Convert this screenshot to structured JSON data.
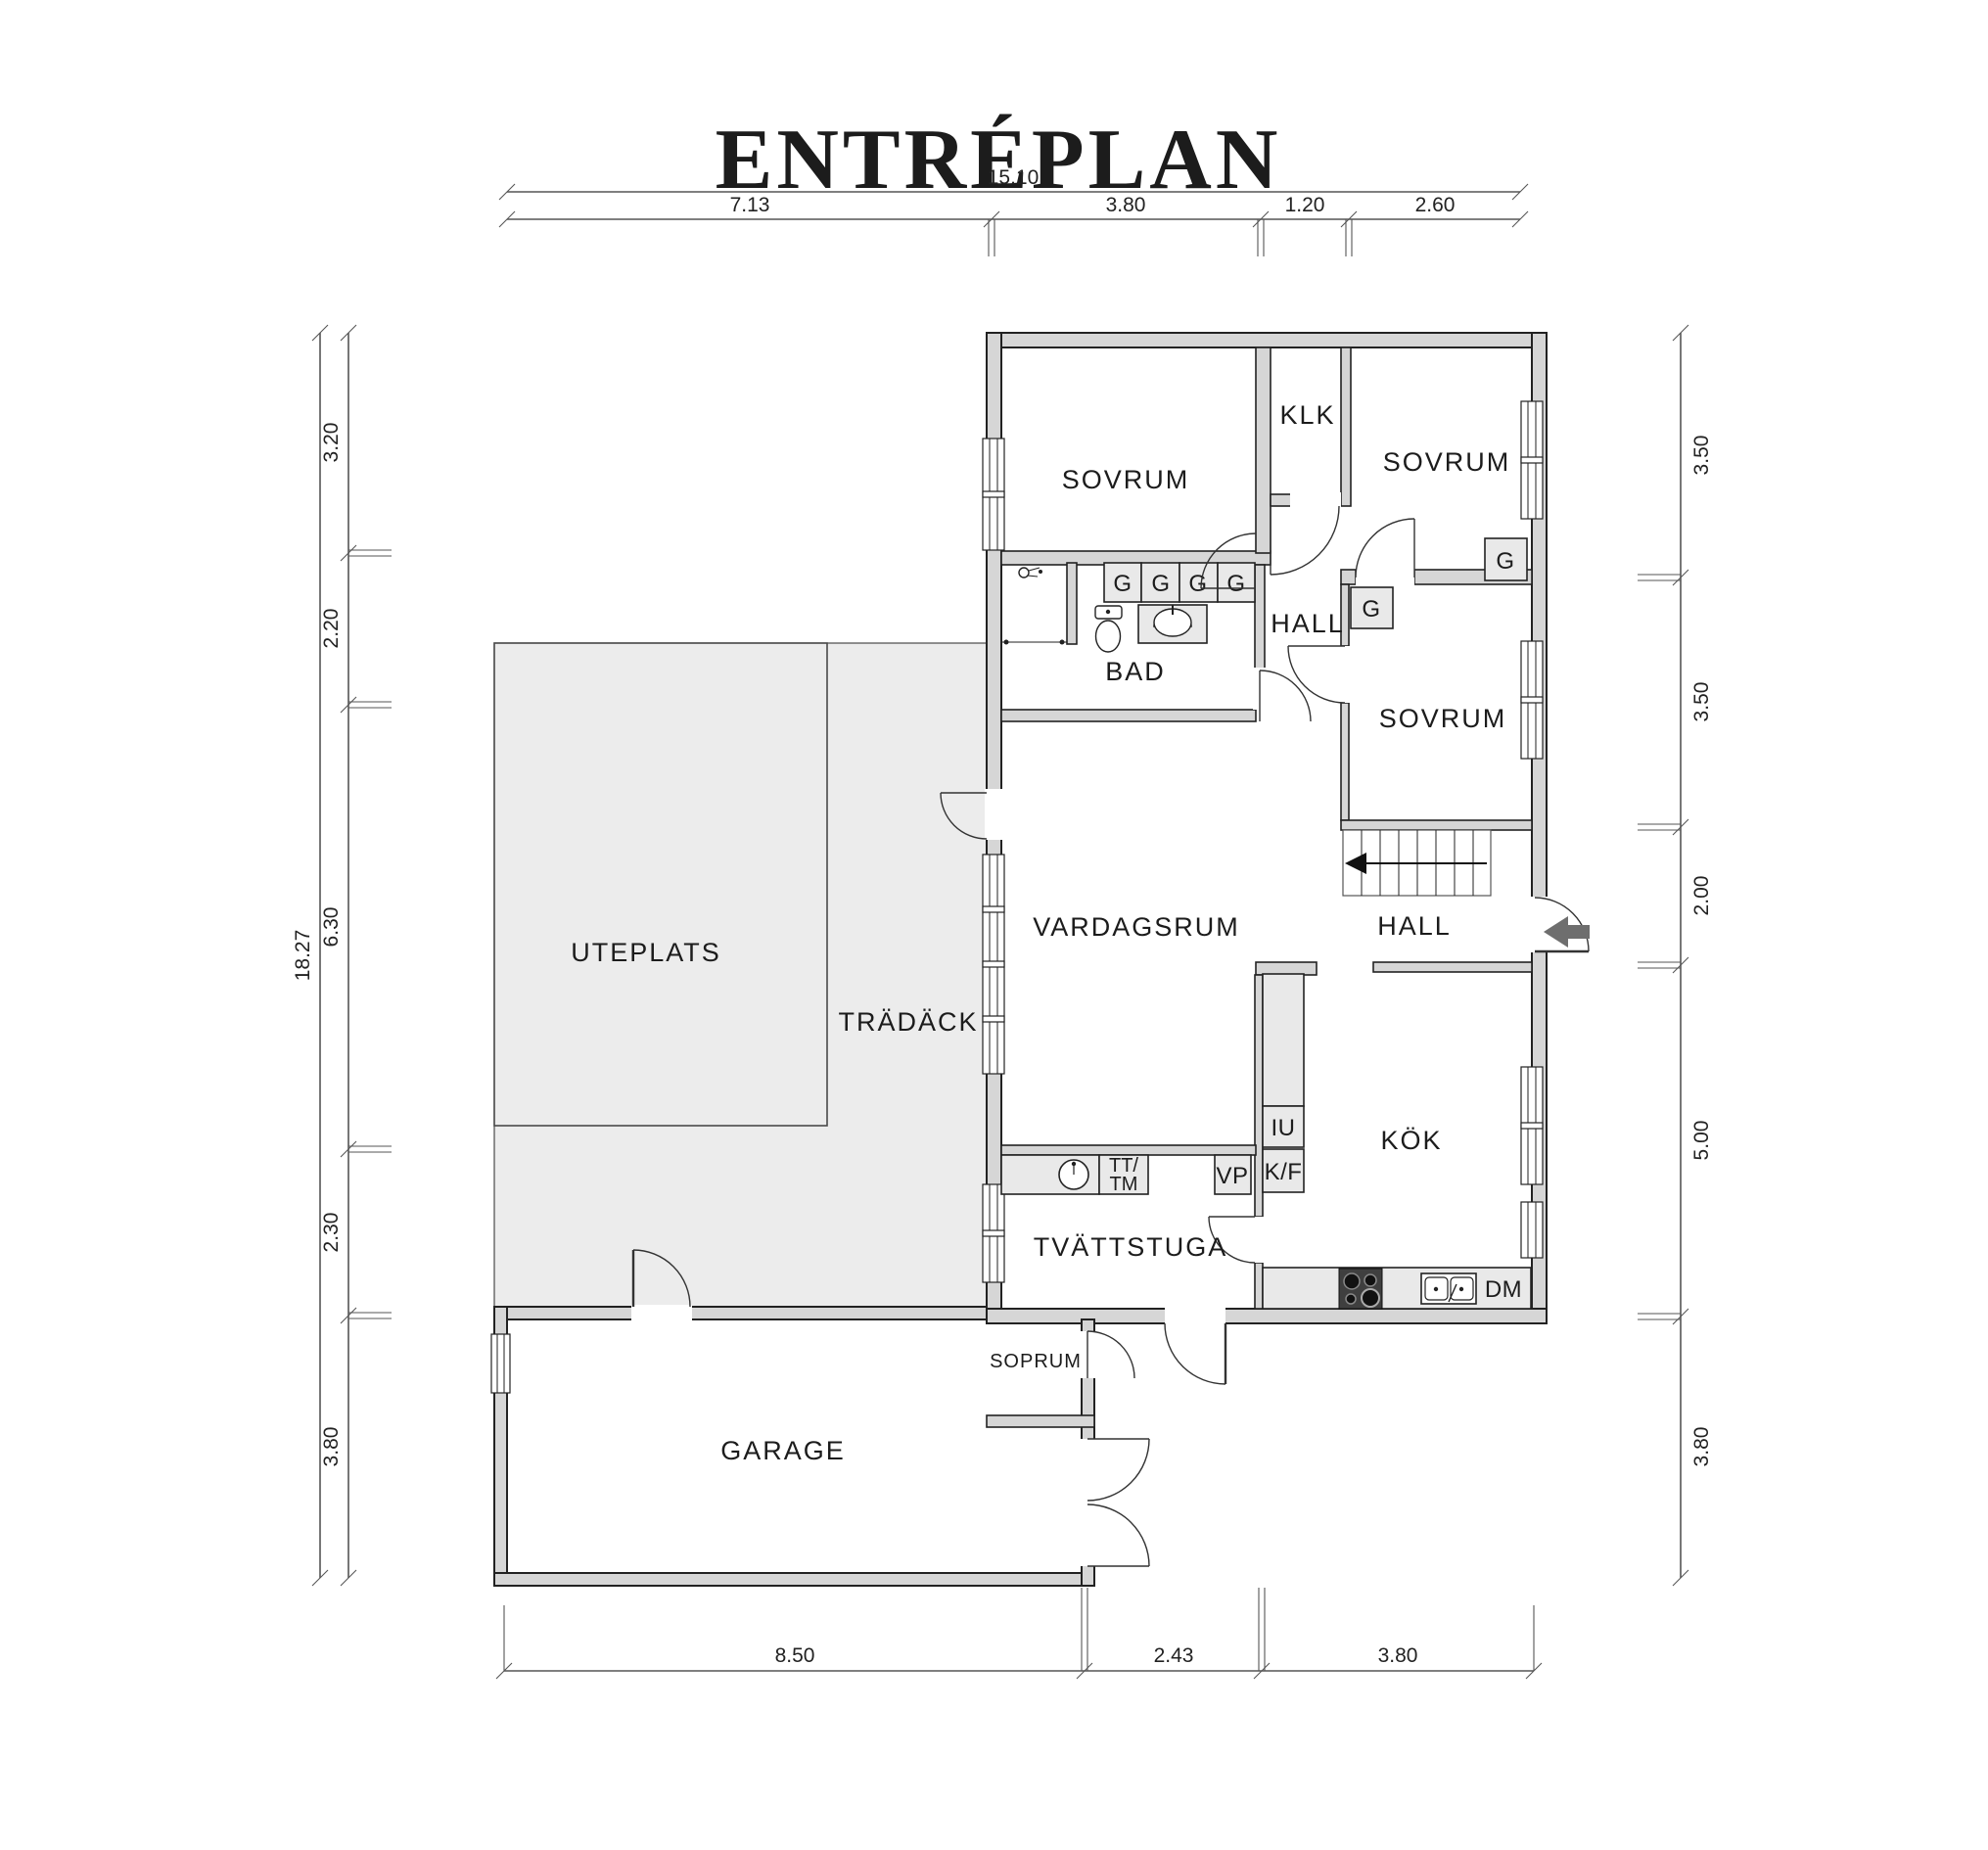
{
  "title": "ENTRÉPLAN",
  "rooms": {
    "sovrum1": "SOVRUM",
    "klk": "KLK",
    "sovrum2": "SOVRUM",
    "hall_upper": "HALL",
    "sovrum3": "SOVRUM",
    "bad": "BAD",
    "vardagsrum": "VARDAGSRUM",
    "hall_lower": "HALL",
    "kok": "KÖK",
    "tvattstuga": "TVÄTTSTUGA",
    "uteplats": "UTEPLATS",
    "tradack": "TRÄDÄCK",
    "garage": "GARAGE",
    "soprum": "SOPRUM"
  },
  "fixtures": {
    "g": "G",
    "dm": "DM",
    "vp": "VP",
    "iu": "IU",
    "kf": "K/F",
    "tt": "TT/",
    "tm": "TM"
  },
  "dimensions": {
    "top": {
      "total": "15.10",
      "segments": [
        "7.13",
        "3.80",
        "1.20",
        "2.60"
      ]
    },
    "left": {
      "total": "18.27",
      "segments": [
        "3.20",
        "2.20",
        "6.30",
        "2.30",
        "3.80"
      ]
    },
    "right": {
      "segments": [
        "3.50",
        "3.50",
        "2.00",
        "5.00",
        "3.80"
      ]
    },
    "bottom": {
      "segments": [
        "8.50",
        "2.43",
        "3.80"
      ]
    }
  },
  "colors": {
    "wall_fill": "#d6d6d6",
    "deck_fill": "#ececec",
    "fixture_fill": "#e9e9e9",
    "ink": "#1c1c1c",
    "entry_arrow": "#6e6e6e"
  }
}
